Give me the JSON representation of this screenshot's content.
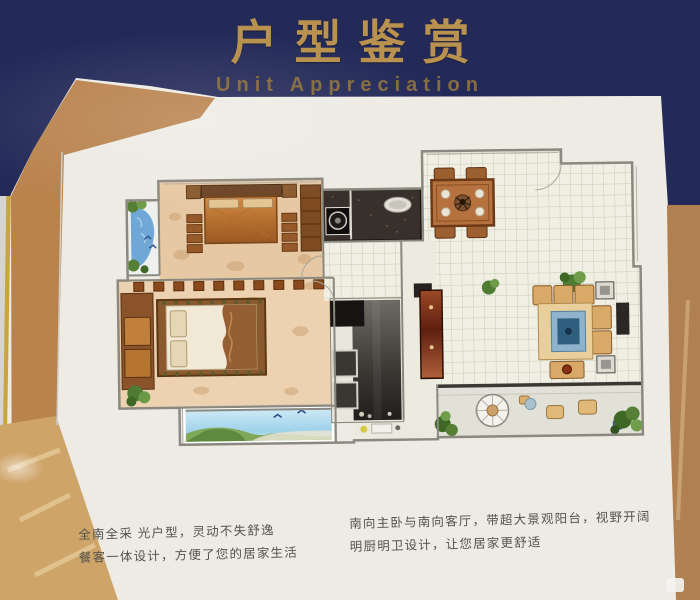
{
  "header": {
    "title_zh": "户型鉴赏",
    "title_en": "Unit Appreciation"
  },
  "descriptions": {
    "left_line1": "全南全采 光户型，灵动不失舒逸",
    "left_line2": "餐客一体设计，方便了您的居家生活",
    "right_line1": "南向主卧与南向客厅，带超大景观阳台，视野开阔",
    "right_line2": "明厨明卫设计，让您居家更舒适"
  },
  "floor_plan": {
    "depicted_rooms": [
      "master-bedroom",
      "second-bedroom",
      "kitchen",
      "bathroom",
      "entry-hall",
      "dining-room",
      "living-room",
      "bedroom-balcony",
      "landscape-balcony",
      "living-balcony"
    ]
  },
  "colors": {
    "header_band": "#242a58",
    "header_text": "#b8924e",
    "wall_accent_tan": "#b9834e",
    "wood_floor_photo": "#cfa469",
    "poster_white": "#edebe4",
    "plan_wood": "#e9cba6",
    "tile_line": "#c2ccb6",
    "kitchen_counter": "#38302a",
    "balcony_water": "#6fa8d6",
    "balcony_sky": "#aee0f2",
    "sofa_tan": "#d9a968",
    "rug_blue": "#8fb3cc",
    "cabinet_maroon": "#8a3a1e",
    "dining_table": "#b5723f"
  }
}
